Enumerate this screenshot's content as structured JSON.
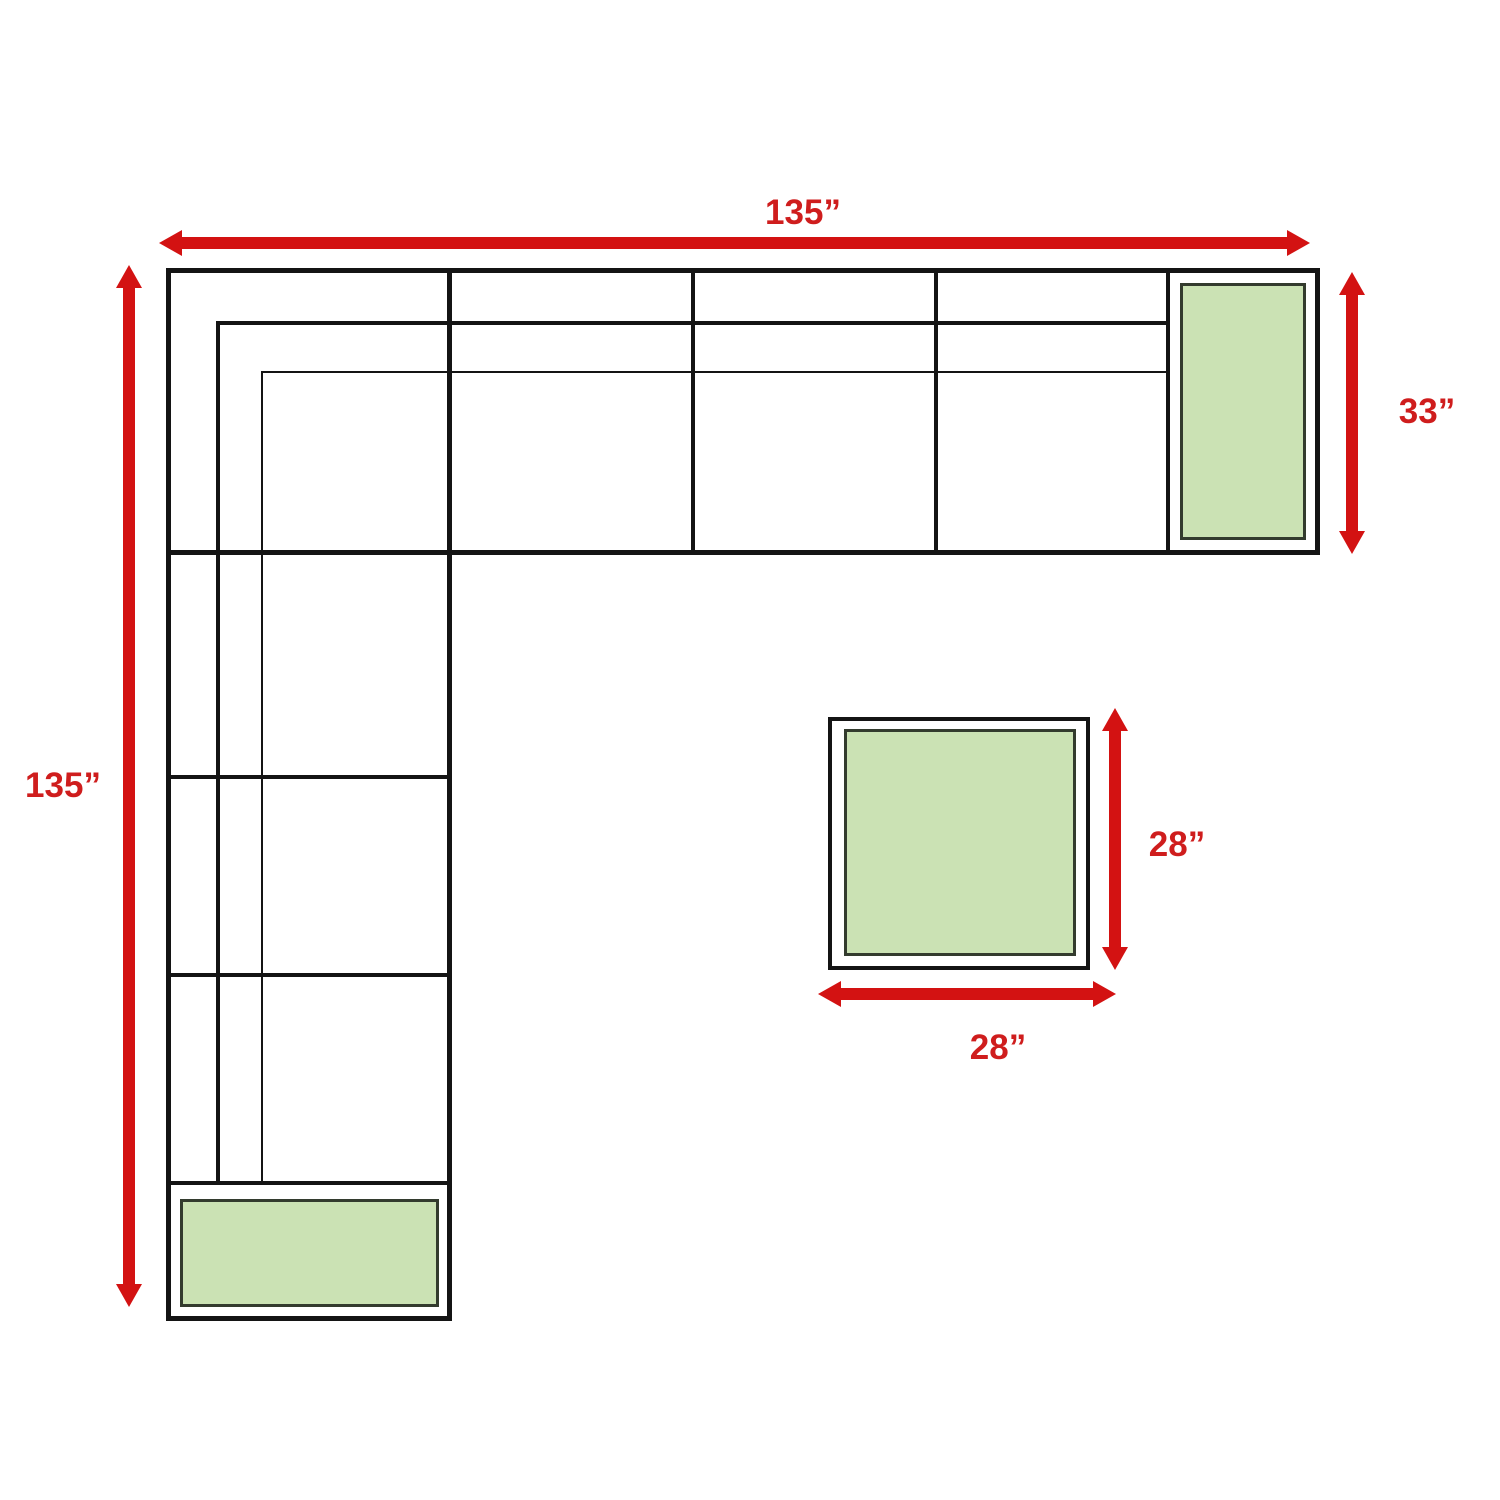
{
  "colors": {
    "arrow-red": "#d31212",
    "label-red": "#cf1d1d",
    "line-black": "#141414",
    "table-green": "#cbe2b4",
    "table-border": "#333b2e",
    "background": "#ffffff"
  },
  "labels": {
    "sofa_width": "135”",
    "sofa_height": "135”",
    "corner_section_depth": "33”",
    "ottoman_height": "28”",
    "ottoman_width": "28”"
  }
}
